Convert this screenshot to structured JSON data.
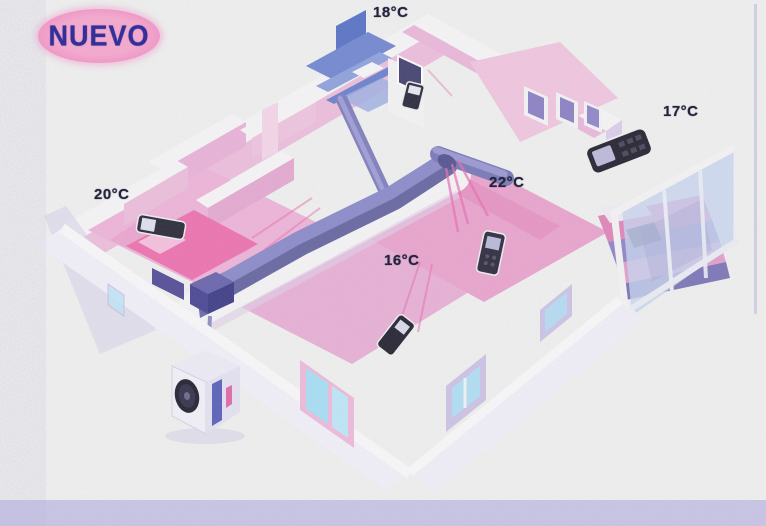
{
  "badge": {
    "label": "NUEVO"
  },
  "zones": [
    {
      "name": "zone-18c",
      "temp": "18°C"
    },
    {
      "name": "zone-17c",
      "temp": "17°C"
    },
    {
      "name": "zone-20c",
      "temp": "20°C"
    },
    {
      "name": "zone-22c",
      "temp": "22°C"
    },
    {
      "name": "zone-16c",
      "temp": "16°C"
    }
  ],
  "colors": {
    "paper": "#f1f2ee",
    "bottom_strip": "#c9c7e4",
    "badge_fill": "#ee9dc7",
    "badge_text": "#34309a",
    "label_text": "#23233c",
    "wall_pink": "#eec0db",
    "floor_pink": "#eba6cc",
    "bed_pink": "#ee74ad",
    "duct_purple": "#7a7ab8",
    "bathroom_blue": "#5a74c4",
    "window_cyan": "#aee2f4",
    "glass_blue": "#c9d6ee",
    "remote_dark": "#26242f",
    "airflow_pink": "#e86fb0"
  }
}
